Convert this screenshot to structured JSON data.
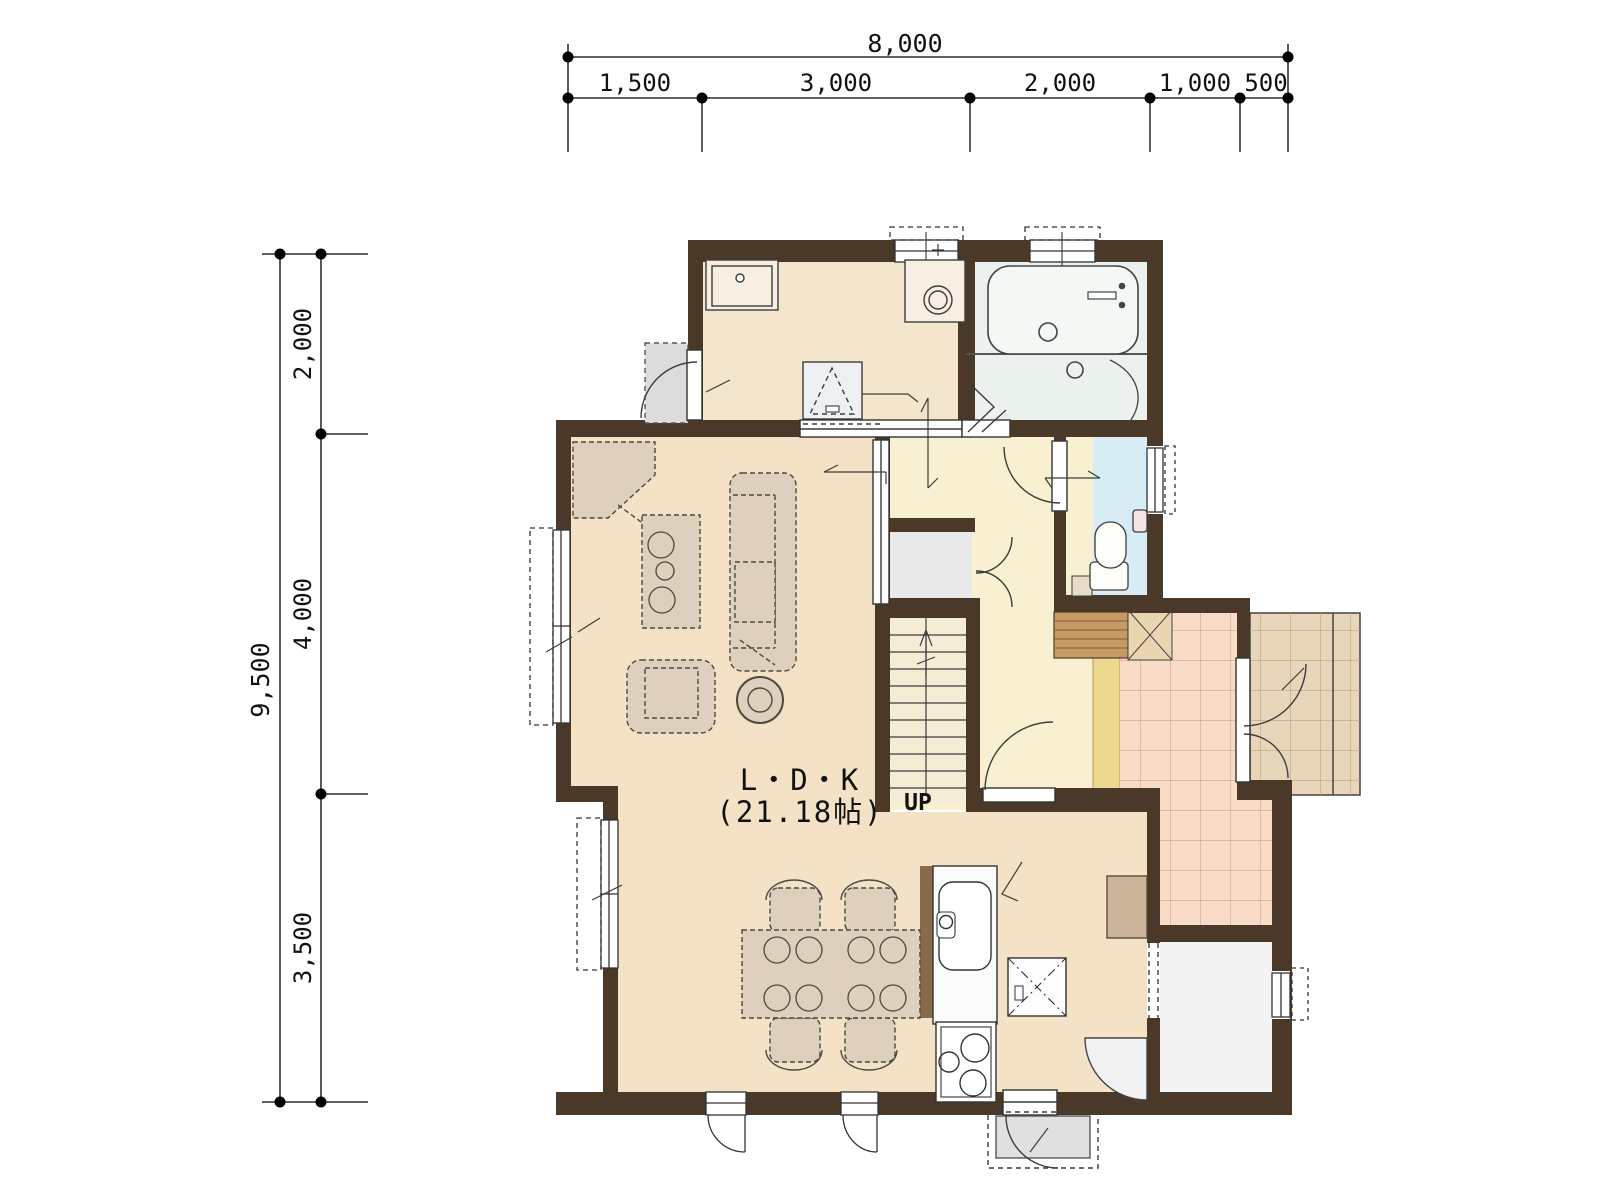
{
  "plan": {
    "floor_labels": {
      "room": "L・D・K",
      "area": "(21.18帖)",
      "stairs": "UP"
    },
    "dimensions": {
      "top": {
        "total": "8,000",
        "segments": [
          "1,500",
          "3,000",
          "2,000",
          "1,000",
          "500"
        ]
      },
      "left": {
        "total": "9,500",
        "segments": [
          "2,000",
          "4,000",
          "3,500"
        ]
      }
    },
    "colors": {
      "wall": "#4a3928",
      "ldk_floor": "#f3e2c5",
      "hall_floor": "#f8f0d0",
      "utility_floor": "#f4e6cd",
      "bath_floor": "#ebf1ec",
      "toilet_floor": "#d8ecf6",
      "genkan_tile": "#f8dcc8",
      "porch_tile": "#e7d6ba",
      "storage_floor": "#f3f3f3",
      "closet_floor": "#e9e9e9",
      "furniture": "#ded0bd",
      "wood_step": "#c89a63",
      "accent_strip": "#ecd88e"
    }
  }
}
